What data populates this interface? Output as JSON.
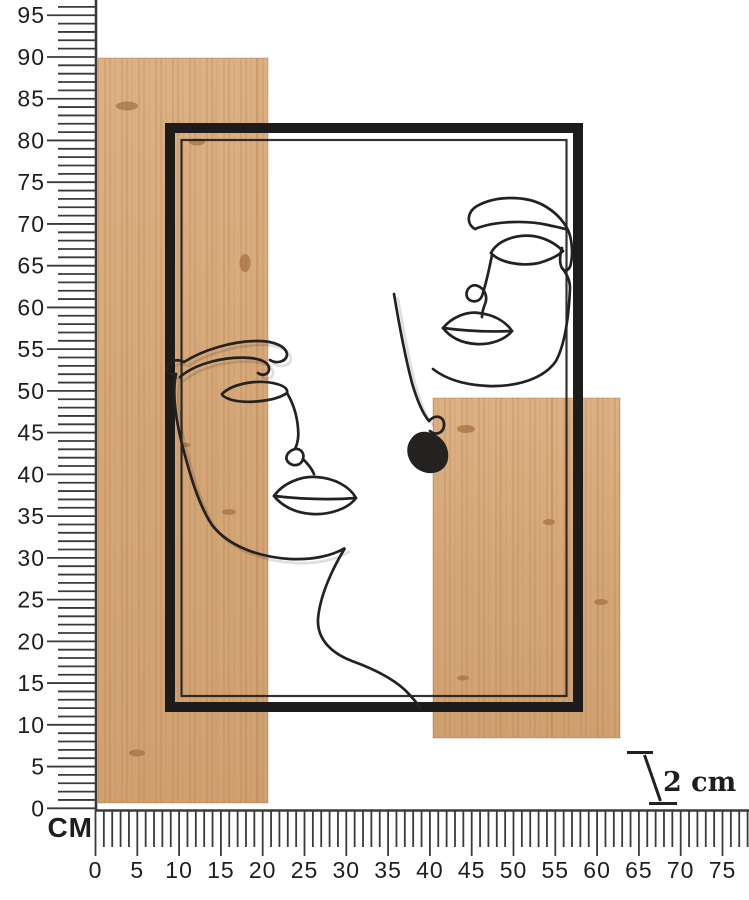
{
  "page": {
    "background": "#ffffff",
    "description": "Dimension diagram of a wall decoration: one-line wire faces inside a black metal frame mounted on two natural wood planks, measured against centimetre rulers"
  },
  "rulers": {
    "unit_label": "CM",
    "vertical": {
      "orientation": "vertical",
      "tick_unit_cm": 1,
      "label_step_cm": 5,
      "min_cm": 0,
      "max_visible_cm": 96,
      "labels": [
        0,
        5,
        10,
        15,
        20,
        25,
        30,
        35,
        40,
        45,
        50,
        55,
        60,
        65,
        70,
        75,
        80,
        85,
        90,
        95
      ]
    },
    "horizontal": {
      "orientation": "horizontal",
      "tick_unit_cm": 1,
      "label_step_cm": 5,
      "min_cm": 0,
      "max_visible_cm": 78,
      "labels": [
        0,
        5,
        10,
        15,
        20,
        25,
        30,
        35,
        40,
        45,
        50,
        55,
        60,
        65,
        70,
        75
      ]
    }
  },
  "depth_indicator": {
    "label": "2 cm",
    "depth_cm": 2
  },
  "product": {
    "name": "wire-faces-wall-decor",
    "parts": [
      {
        "name": "wood-panel-left",
        "approx_size_cm": "20 x 90"
      },
      {
        "name": "wood-panel-right",
        "approx_size_cm": "22 x 41"
      },
      {
        "name": "metal-frame",
        "approx_size_cm": "50 x 70"
      },
      {
        "name": "wire-face-left"
      },
      {
        "name": "wire-face-right"
      },
      {
        "name": "earring"
      }
    ]
  },
  "colors": {
    "background": "#ffffff",
    "wood": "#d5a778",
    "wood_light": "#ddb185",
    "wood_grain": "#b9854f",
    "wood_knot": "#a06a3c",
    "frame": "#1e1c1a",
    "wire": "#242220",
    "ruler": "#3a3a3a",
    "label_text": "#1e1e1e"
  }
}
